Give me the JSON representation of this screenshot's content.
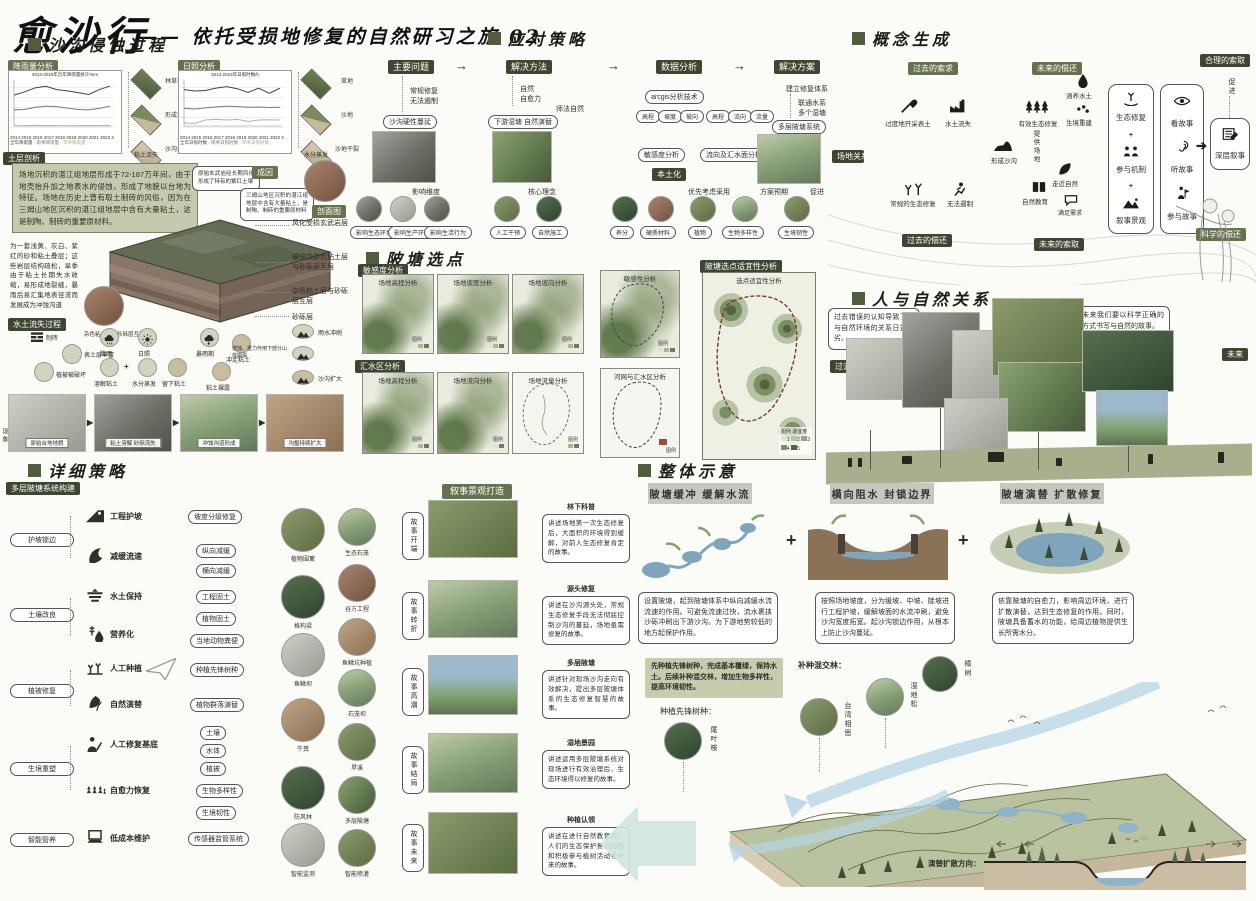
{
  "header": {
    "title": "愈沙行",
    "subtitle": "—— 依托受损地修复的自然研习之旅 02"
  },
  "colors": {
    "accent": "#4f5d3d",
    "chip": "#66724d",
    "chip_dark": "#3c4630",
    "map_green": "#69815a",
    "water": "#8fb3c8",
    "sand": "#cbbda4"
  },
  "s1": {
    "heading": "沙沟侵蚀过程",
    "rain_tag": "降雨量分析",
    "sun_tag": "日照分析",
    "rain_chart": {
      "type": "line",
      "title": "2013-2023年历年降雨量统计/mm",
      "x": [
        "2014",
        "2015",
        "2016",
        "2017",
        "2018",
        "2019",
        "2020",
        "2021",
        "2022",
        "2023"
      ],
      "series": [
        {
          "name": "全年降雨量",
          "values": [
            1450,
            1600,
            1780,
            1850,
            1700,
            1640,
            1560,
            1480,
            1700,
            1860
          ]
        },
        {
          "name": "雨季降雨量",
          "values": [
            780,
            800,
            900,
            950,
            930,
            860,
            800,
            780,
            850,
            950
          ]
        },
        {
          "name": "旱季降雨量",
          "values": [
            60,
            70,
            80,
            75,
            70,
            65,
            70,
            75,
            70,
            80
          ]
        }
      ]
    },
    "sun_chart": {
      "type": "line",
      "title": "2013-2023年日照时数/h",
      "x": [
        "2014",
        "2015",
        "2016",
        "2017",
        "2018",
        "2019",
        "2020",
        "2021",
        "2022",
        "2023"
      ],
      "series": [
        {
          "name": "全年日照时数",
          "values": [
            1750,
            1700,
            1720,
            1800,
            1850,
            1780,
            1650,
            1800,
            1620,
            1800
          ]
        },
        {
          "name": "雨季日照时数",
          "values": [
            1100,
            1080,
            1120,
            1150,
            1180,
            1160,
            1140,
            1150,
            1130,
            1140
          ]
        },
        {
          "name": "旱季日照时数",
          "values": [
            600,
            580,
            700,
            720,
            700,
            720,
            650,
            700,
            710,
            700
          ]
        }
      ]
    },
    "rain_diamonds": [
      "林草覆盖",
      "形成沙沟",
      "沙沟扩大"
    ],
    "rain_caption": "粘土流失",
    "sun_diamonds": [
      "草地",
      "沙地",
      "沙地干裂"
    ],
    "sun_caption": "水分蒸发",
    "strata_tag": "土层剖析",
    "cause_text": "场地沉积的湛江组地层形成于72-187万年间，由于地壳抬升加之地表水的侵蚀，形成了地貌以台地为特征。场地在历史上曾有取土制砖的风俗，因为在三姆山地区沉积的湛江组地层中含有大量粘土，这是制陶、制砖的重要原材料。",
    "inset_tag": "成因",
    "inset_note1": "原始玄武岩经长期风化形成了特有的紫红土壤",
    "inset_note2": "三姆山地区沉积的湛江组地层中含有大量粘土，是制陶、制砖的重要原材料",
    "inset_tag2": "剖面图",
    "layers": [
      "风化受损玄武岩层",
      "被侵蚀杂色粘土层与砂砾层互层",
      "杂色粘土层与砂砾层互层",
      "砂砾层"
    ],
    "block_caption": "杂色粘土层与砂砾层互层",
    "sand_text": "为一套浅黄、灰白、紫红的砂和粘土叠层；这些岩层结构疏松，旱季由于粘土长期失水收缩，易形成地裂缝，暴雨后易汇集地表径流而发展成为冲蚀沟道",
    "process_tag": "水土流失过程",
    "p_brick": "制砖",
    "p_topsoil": "表土层丰富",
    "p_veg": "植被被破坏",
    "p_rain": "降雨",
    "p_sun": "日照",
    "p_dissolve": "溶解粘土",
    "p_evap": "水分蒸发",
    "p_clay": "留下粘土",
    "p_storm": "暴雨期",
    "p_wash": "冲走粘土",
    "p_bare": "粘土裸露",
    "p_erode": "雨水冲刷",
    "p_collapse": "侵蚀、重力作用下部分山体崩塌",
    "p_expand": "沙沟扩大",
    "stages": [
      "原始台地地貌",
      "粘土溶解 砂砾流失",
      "冲蚀沟道形成",
      "沟壑持续扩大"
    ],
    "phenomenon": "现象"
  },
  "s2": {
    "heading": "应对策略",
    "step1": "主要问题",
    "step2": "解决方法",
    "step3": "数据分析",
    "step4": "解决方案",
    "c1_note1": "常规修复",
    "c1_note2": "无法遏制",
    "c1_sub": "沙沟硬性蔓延",
    "c1_below": "影响维度",
    "c1_circles": [
      "影响生态环境",
      "影响生产环境",
      "影响生活行为"
    ],
    "c2_note1": "自然",
    "c2_note2": "自愈力",
    "c2_note3": "师法自然",
    "c2_sub": "下游湿塘 自然演替",
    "c2_below": "核心理念",
    "c2_circles": [
      "人工干预",
      "自然施工"
    ],
    "c3_tool": "arcgis分析技术",
    "c3_boxes1": [
      "高程",
      "坡度",
      "坡向"
    ],
    "c3_boxes2": [
      "高程",
      "流向",
      "流量"
    ],
    "c3_chip1": "敏感度分析",
    "c3_chip2": "流向及汇水面分析",
    "c3_tag": "本土化",
    "c3_below": "优先考虑采用",
    "c3_circles": [
      "养分",
      "硬质材料",
      "植物",
      "生物多样性"
    ],
    "c4_note1": "建立修复体系",
    "c4_note2": "联通水系",
    "c4_note3": "多个湿塘",
    "c4_sub": "多层陂塘系统",
    "c4_below1": "方案预期",
    "c4_below2": "促进",
    "c4_circles": [
      "生境韧性"
    ]
  },
  "s3": {
    "heading": "概念生成",
    "tag_past_demand": "过去的索求",
    "tag_future_repay": "未来的偿还",
    "tag_reasonable": "合理的索取",
    "tag_past_repay": "过去的偿还",
    "tag_future_demand": "未来的索取",
    "tag_science": "科学的偿还",
    "site": "场地关系",
    "i_mine": "过度地开采表土",
    "i_loss": "水土流失",
    "i_gully": "形成沙沟",
    "i_normal": "常规的生态修复",
    "i_fail": "无法遏制",
    "i_edu": "自然教育",
    "i_eco": "有效生态修复",
    "i_water": "涵养水土",
    "i_habitat": "生境重建",
    "i_provide": "提供场地",
    "i_close": "走近自然",
    "i_satisfy": "满足需求",
    "p1": [
      "生态修复",
      "参与机制",
      "叙事景观"
    ],
    "plus": "+",
    "p2": [
      "看故事",
      "听故事",
      "参与故事"
    ],
    "deep": "深层叙事",
    "promote": "促进"
  },
  "s4": {
    "heading": "陂塘选点",
    "tag1": "敏感度分析",
    "tag2": "汇水区分析",
    "tag3": "陂塘选点适宜性分析",
    "row1": [
      "场地高程分析",
      "场地坡度分析",
      "场地坡向分析",
      "敏感性分析"
    ],
    "row2": [
      "场地高程分析",
      "场地流向分析",
      "场地流量分析",
      "河网与汇水区分析"
    ],
    "big": "选点适宜性分析",
    "legend": "图例",
    "legend_title": "适宜度",
    "legend_values": [
      "1",
      "2",
      "3",
      "4",
      "5"
    ]
  },
  "s5": {
    "heading": "人与自然关系",
    "past_text": "过去错误的认知导致了人与自然环境的关系日益恶劣。",
    "future_text": "未来我们要以科学正确的方式书写与自然的故事。",
    "tag_past": "过去",
    "tag_future": "未来"
  },
  "s6": {
    "heading": "详细策略",
    "tag": "多层陂塘系统构建",
    "g": [
      "护坡锁边",
      "土壤改良",
      "植被修复",
      "生境重塑",
      "智能管养"
    ],
    "items": [
      "工程护坡",
      "减缓流速",
      "水土保持",
      "营养化",
      "人工种植",
      "自然演替",
      "人工修复基底",
      "自愈力恢复",
      "低成本维护"
    ],
    "chips": [
      "坡度分级修复",
      "纵向减缓",
      "横向减缓",
      "工程固土",
      "植物固土",
      "当地动物粪便",
      "种植先锋树种",
      "植物群落演替",
      "土壤",
      "水体",
      "植被",
      "生物多样性",
      "生境韧性",
      "传感器监管系统"
    ],
    "circles_left": [
      "植物围篱",
      "格构梁",
      "鱼鳞坝",
      "牛粪",
      "防风林",
      "智能监测"
    ],
    "circles_right": [
      "生态石笼",
      "谷方工程",
      "鱼鳞坑种植",
      "石笼坝",
      "旱溪",
      "多层陂塘",
      "智能喷灌"
    ],
    "story_tag": "叙事景观打造",
    "stories": [
      {
        "stage": "故事开端",
        "title": "林下科普",
        "text": "讲述场地第一次生态修复后，大面积的环境得到缓解，对前人生态修复肯定的故事。"
      },
      {
        "stage": "故事转折",
        "title": "源头修复",
        "text": "讲述在沙沟源头处，常规生态修复手段无法彻底控制沙沟的蔓延，场地亟需修复的故事。"
      },
      {
        "stage": "故事高潮",
        "title": "多层陂塘",
        "text": "讲述针对现场沙沟走向有效解决，提出多层陂塘体系的生态修复智慧的故事。"
      },
      {
        "stage": "故事结局",
        "title": "湿地景园",
        "text": "讲述运用多层陂塘系统对现场进行有效治理后，生态环境得以修复的故事。"
      },
      {
        "stage": "故事未来",
        "title": "种植认领",
        "text": "讲述在进行自然教育后，人们的生态保护意识加强和积极参与植树活动等未来的故事。"
      }
    ]
  },
  "s7": {
    "heading": "整体示意",
    "plus": "+",
    "concepts": [
      {
        "title": "陂塘缓冲 缓解水流",
        "text": "设置陂塘，起到陂塘体系中纵向减缓水流流速的作用。可避免流速过快，流水裹挟沙砾冲刷出下游沙沟。为下游地势较低的地方起保护作用。"
      },
      {
        "title": "横向阻水 封锁边界",
        "text": "按照场地坡度，分为缓坡、中坡、陡坡进行工程护坡，缓解坡面的水流冲刷，避免沙沟宽度拓宽。起沙沟锁边作用，从根本上防止沙沟蔓延。"
      },
      {
        "title": "陂塘演替 扩散修复",
        "text": "依靠陂塘的自愈力，影响周边环境，进行扩散演替，达到生态修复的作用。同时，陂塘具备蓄水的功能，给周边植物提供生长所需水分。"
      }
    ],
    "note": "先种植先锋树种，完成基本覆绿，保持水土。后续补种混交林，增加生物多样性，提高环境韧性。",
    "pioneer_label": "种植先锋树种：",
    "pioneer": [
      "尾叶桉"
    ],
    "mixed_label": "补种混交林：",
    "mixed": [
      "台湾相思",
      "湿地松",
      "樟树"
    ],
    "direction": "演替扩散方向："
  }
}
